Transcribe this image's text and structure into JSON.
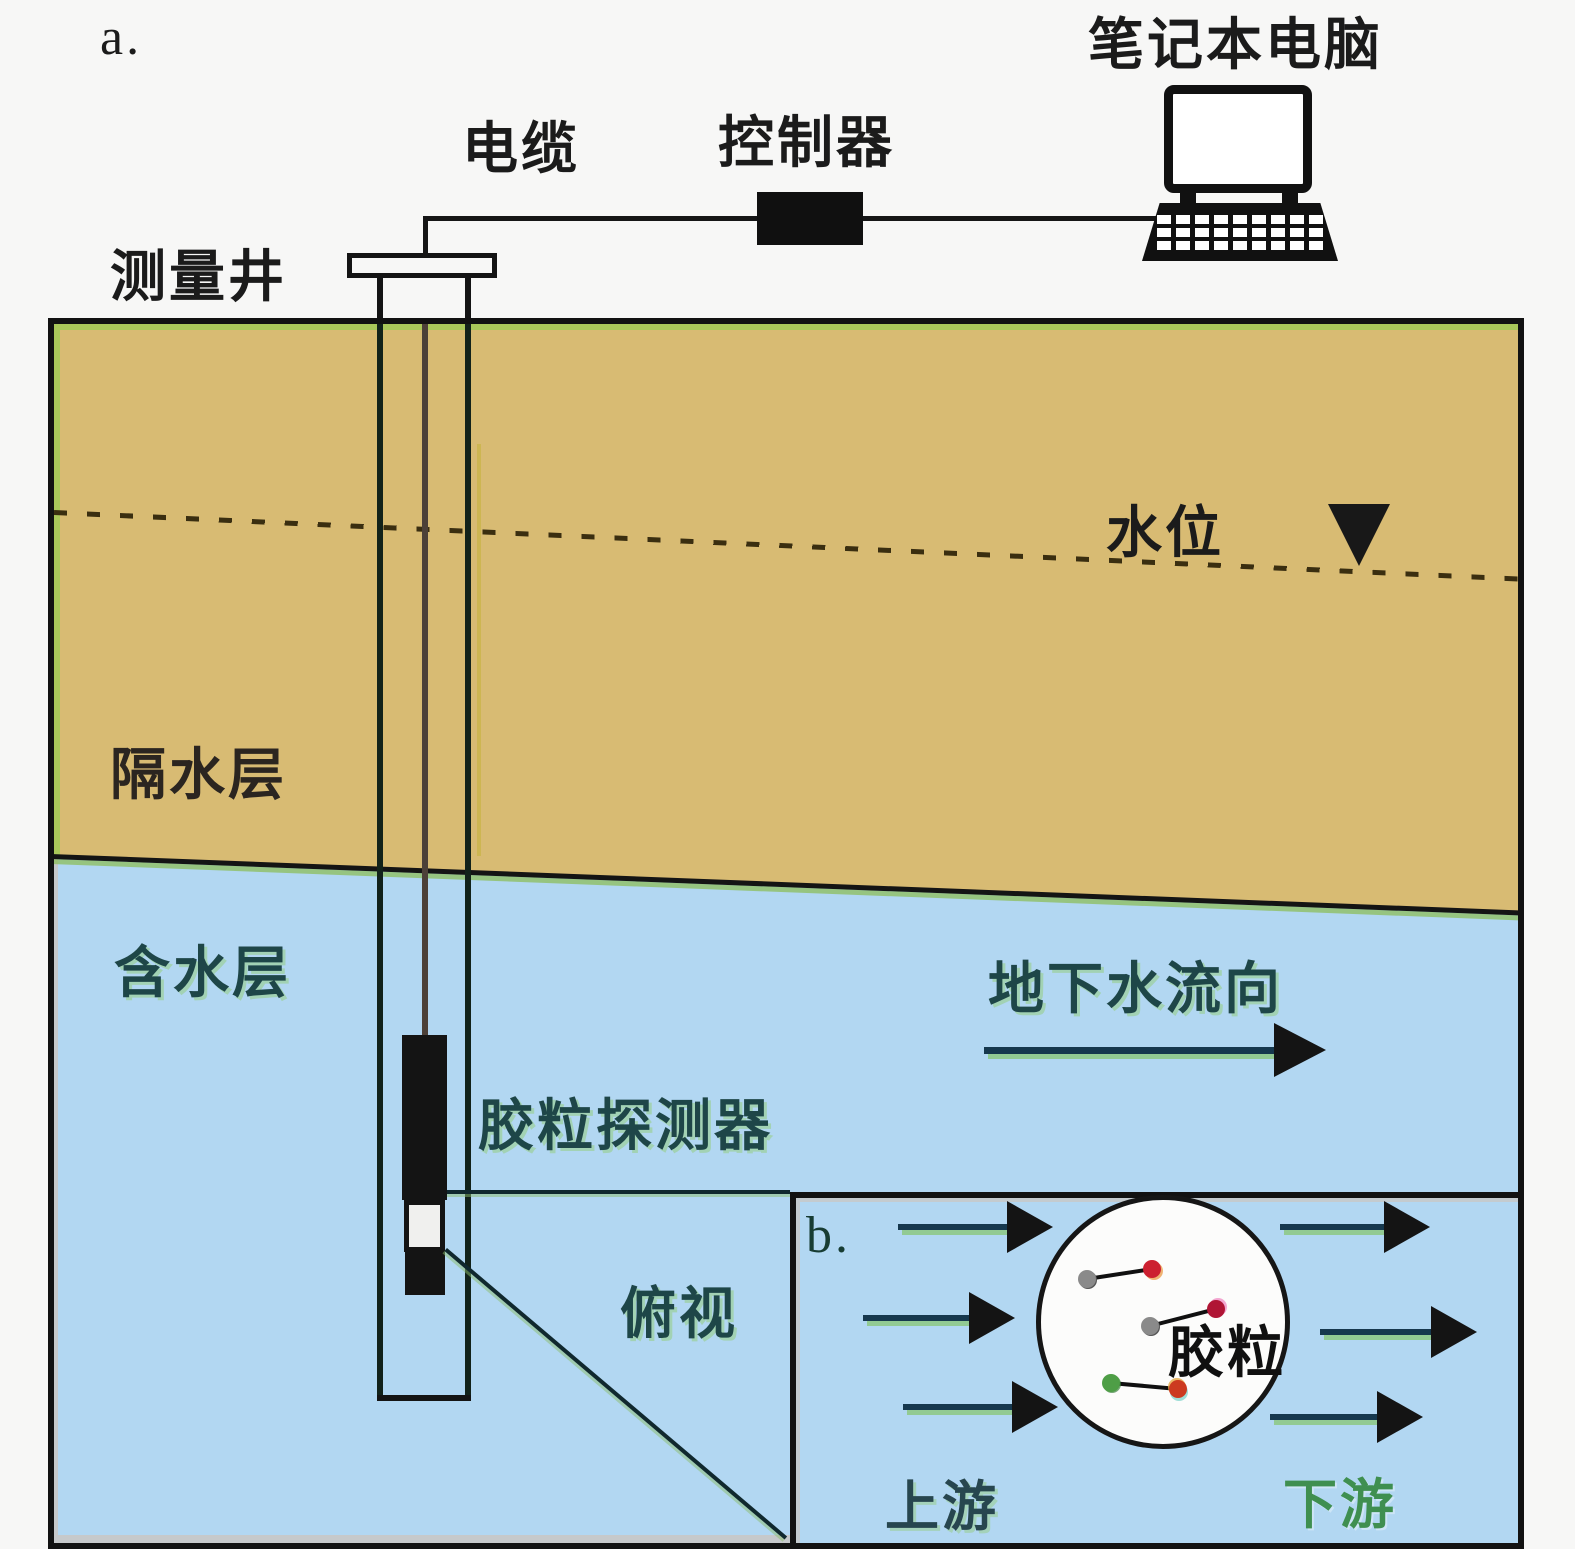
{
  "figure": {
    "panel_a_label": "a.",
    "panel_b_label": "b.",
    "labels": {
      "well": "测量井",
      "cable": "电缆",
      "controller": "控制器",
      "laptop": "笔记本电脑",
      "water_table": "水位",
      "aquitard": "隔水层",
      "aquifer": "含水层",
      "groundwater_flow": "地下水流向",
      "colloid_detector": "胶粒探测器",
      "top_view": "俯视",
      "colloid": "胶粒",
      "upstream": "上游",
      "downstream": "下游"
    },
    "icons": {
      "laptop": "laptop-icon",
      "controller": "controller-box-icon",
      "water_table_marker": "inverted-triangle-icon",
      "flow_arrows": "right-arrow-icon"
    },
    "colors": {
      "background": "#f7f7f6",
      "aquitard_fill": "#d8bb73",
      "aquifer_fill": "#b2d7f2",
      "green_edge": "#aac85a",
      "arrow_shaft": "#16384e",
      "arrow_head": "#141414",
      "teal_label": "#1e4648",
      "downstream_green": "#3f8f50",
      "circle_fill": "#fcfcfb"
    },
    "particles": [
      {
        "start_color": "#8a8a8a",
        "end_color": "#cc2030",
        "note": "gray-to-red displacement"
      },
      {
        "start_color": "#8a8a8a",
        "end_color": "#b01535",
        "note": "gray-to-crimson displacement"
      },
      {
        "start_color": "#4e9e46",
        "end_color": "#cc3a20",
        "note": "green-to-red displacement"
      }
    ],
    "flow": {
      "direction": "left-to-right",
      "upstream_arrow_count": 3,
      "downstream_arrow_count": 3
    }
  }
}
